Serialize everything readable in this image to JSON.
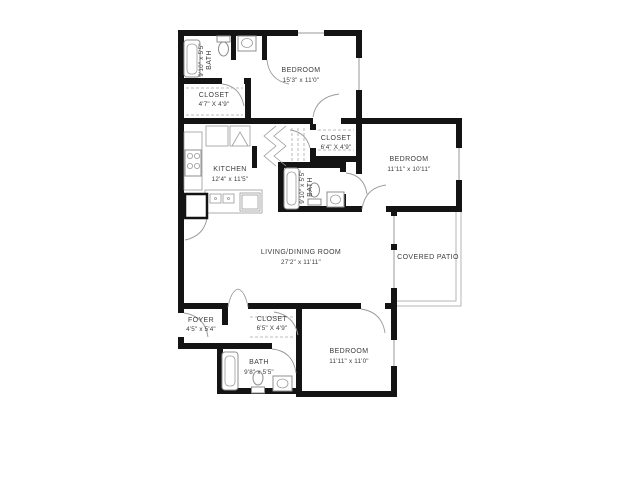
{
  "colors": {
    "wall": "#141414",
    "fixture_outline": "#8f8f8f",
    "text": "#3c3c3c",
    "background": "#ffffff"
  },
  "rooms": {
    "bath_top": {
      "name": "BATH",
      "dims": "9'10\" x 5'5\""
    },
    "closet_top": {
      "name": "CLOSET",
      "dims": "4'7\" X 4'9\""
    },
    "bedroom_top": {
      "name": "BEDROOM",
      "dims": "15'3\" x 11'0\""
    },
    "kitchen": {
      "name": "KITCHEN",
      "dims": "12'4\" x 11'5\""
    },
    "closet_mid": {
      "name": "CLOSET",
      "dims": "6'4\" X 4'9\""
    },
    "bath_mid": {
      "name": "BATH",
      "dims": "9'10\" x 5'5\""
    },
    "bedroom_right": {
      "name": "BEDROOM",
      "dims": "11'11\" x 10'11\""
    },
    "living_dining": {
      "name": "LIVING/DINING ROOM",
      "dims": "27'2\" x 11'11\""
    },
    "covered_patio": {
      "name": "COVERED PATIO",
      "dims": ""
    },
    "foyer": {
      "name": "FOYER",
      "dims": "4'5\" x 5'4\""
    },
    "closet_bottom": {
      "name": "CLOSET",
      "dims": "6'5\" X 4'9\""
    },
    "bath_bottom": {
      "name": "BATH",
      "dims": "9'8\" x 5'5\""
    },
    "bedroom_bottom": {
      "name": "BEDROOM",
      "dims": "11'11\" x 11'0\""
    }
  }
}
